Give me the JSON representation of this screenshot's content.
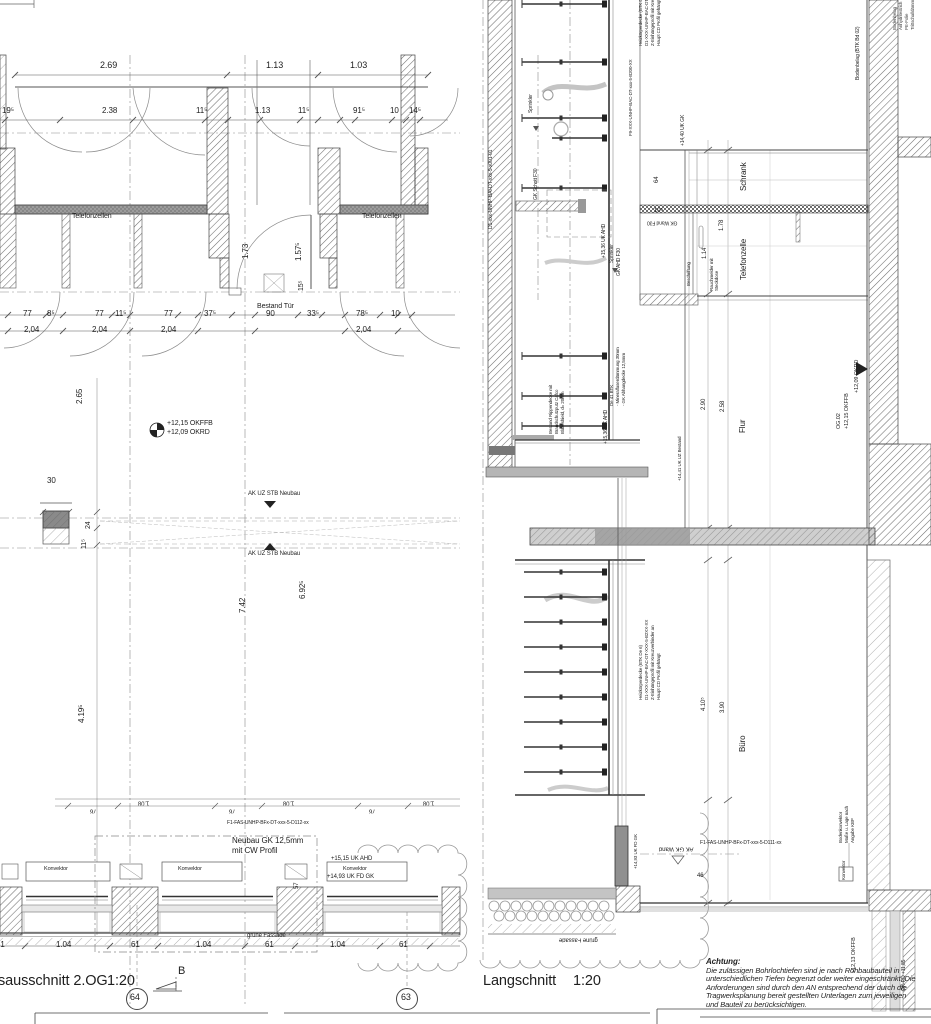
{
  "colors": {
    "line": "#3c3c3c",
    "hatch": "#707070",
    "band": "#9c9c9c",
    "cloud": "#999999"
  },
  "left_plan": {
    "title_partial": "sausschnitt 2.OG",
    "scale": "1:20",
    "section_letter": "B",
    "bubble_left": "64",
    "bubble_right": "63",
    "room_label": "Telefonzellen",
    "door_note": "Bestand Tür",
    "level_okffb": "+12,15 OKFFB",
    "level_okrd": "+12,09 OKRD",
    "beam_note": "AK UZ STB Neubau",
    "facade_code": "F1-FAS-UNHP-BFx-DT-xxx-5-D112-xx",
    "gk_note_1": "Neubau GK 12,5mm",
    "gk_note_2": "mit CW Profil",
    "uk_ahd": "+15,15 UK AHD",
    "uk_fd_gk": "+14,93 UK FD GK",
    "konvektor": "Konvektor",
    "gruene_fassade": "grüne Fassade",
    "dims_top": [
      "2.69",
      "1.13",
      "1.03"
    ],
    "dims_row2": [
      "19⁵",
      "2.38",
      "11⁵",
      "1.13",
      "11⁵",
      "91⁵",
      "10",
      "14⁵"
    ],
    "dims_row3": [
      "77",
      "8⁵",
      "77",
      "11⁵",
      "77",
      "37⁵",
      "90",
      "33⁵",
      "78⁵",
      "10"
    ],
    "dim_204": "2,04",
    "dim_173": "1.73",
    "dim_1575": "1.57⁵",
    "dim_155": "15⁵",
    "dim_265": "2.65",
    "dim_742": "7.42",
    "dim_6925": "6.92⁵",
    "dim_4195": "4.19⁵",
    "dim_30": "30",
    "dim_24": "24",
    "dim_115": "11⁵",
    "dim_57": "57",
    "dim_61": "61",
    "dim_104": "1.04",
    "dim_108": "1.08",
    "dim_76": "76"
  },
  "right_section": {
    "title": "Langschnitt",
    "scale": "1:20",
    "room_schrank": "Schrank",
    "room_telefonzelle": "Telefonzelle",
    "room_flur": "Flur",
    "room_buero": "Büro",
    "wall_code": "D1-xxx-UNHP-BAI-DT-xxx-5-x001-01",
    "gk_schott": "GK Schott F30",
    "sprinkler": "Sprinkler",
    "ceiling_note": [
      "Heizkörperdecke (BTK De 6)",
      "D1-XXX-UNHP-BAC-DT-XXX-5-B2XX-XX",
      "Z-Einhängeprofil mit Kreuzverbinder an",
      "Haupt CD Profil gehängt"
    ],
    "ceiling_code": "F9-XXX-UNHP-BAC-DT-xxx-5-B200-XX",
    "bodenbelag": "Bodenbelag (BTK Bd 02)",
    "floor_buildup": [
      "Bodenbelag",
      "Anhydritestrich",
      "PE-Folie",
      "Trittschalldämmung"
    ],
    "uk_gk_1440": "+14,40 UK GK",
    "gk_wand": "GK Wand F30",
    "gk_ahd": "GK AHD F30",
    "uk_ahd_1536": "+15,36 UK AHD",
    "beschriftung": "Beschriftung",
    "rauchmelder_1": "Rauchmelder mit",
    "rauchmelder_2": "Steckdose",
    "abhang_note": [
      "De 41 BTK",
      "- Mineralfaserdämmung 30mm",
      "- GK Abhangdecke 12,5mm"
    ],
    "bestand_note": [
      "Bestand Rippendecke mit",
      "Brandschutzputz Cafco",
      "Blazeshield, d= 20mm"
    ],
    "uk_uz_1441": "+14,41 UK UZ Bestand",
    "og_label": "OG.02",
    "level_okffb": "+12,15 OKFFB",
    "level_okrd": "+12,09 OKRD",
    "bodenkonvektor": [
      "Bodenkonvektor",
      "Maße u. Lage nach",
      "Angabe KBP"
    ],
    "konvektor": "Konvektor",
    "facade_code": "F1-FAS-UNHP-BFx-DT-xxx-5-D111-xx",
    "ak_gk_wand": "AK GK Wand",
    "gruene_fassade": "grüne Fassade",
    "uk_fd_gk": "+14,93 UK FD GK",
    "level_okffb_1213": "+12,13 OKFFB",
    "level_okrd_1185": "OK-RD +11,85",
    "dim_178": "1.78",
    "dim_114": "1.14",
    "dim_64": "64",
    "dim_105": "10⁵",
    "dim_258": "2.58",
    "dim_290": "2.90",
    "dim_390": "3.90",
    "dim_4105": "4.10⁵",
    "dim_46": "46"
  },
  "achtung": {
    "title": "Achtung:",
    "lines": [
      "Die zulässigen Bohrlochtiefen sind je nach Rohbaubauteil in",
      "unterschiedlichen Tiefen begrenzt oder weiter eingeschränkt. Die",
      "Anforderungen sind durch den AN entsprechend der durch die",
      "Tragwerksplanung bereit gestellten Unterlagen zum jeweiligen",
      "und Bauteil zu berücksichtigen."
    ]
  }
}
